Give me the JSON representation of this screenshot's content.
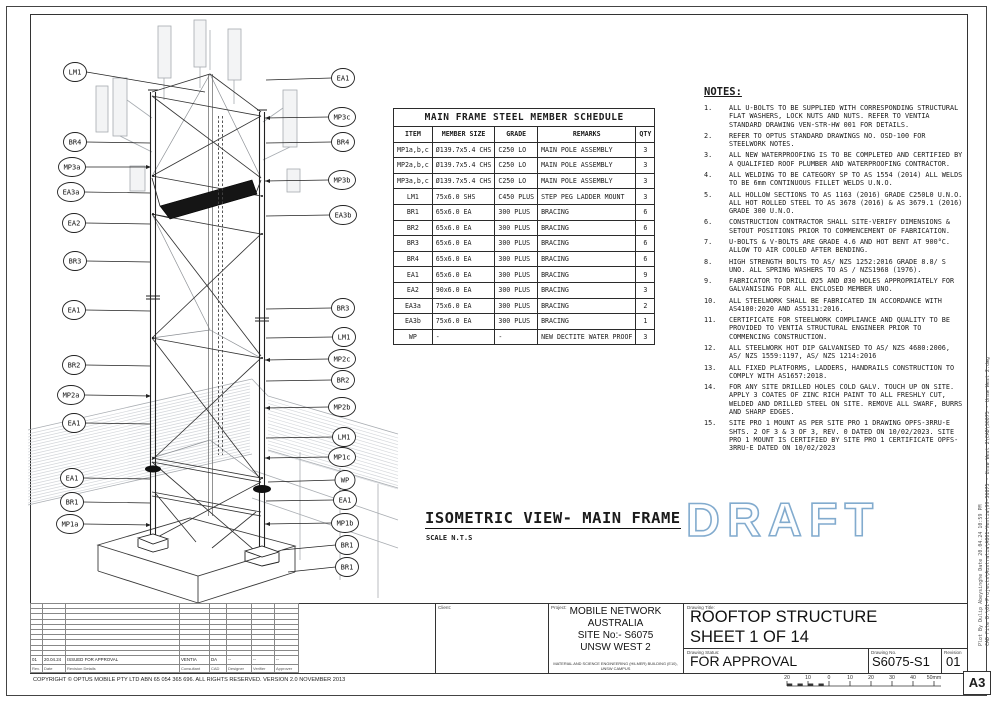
{
  "sheet": {
    "paper_size": "A3",
    "copyright": "COPYRIGHT © OPTUS MOBILE PTY LTD  ABN 65 054 365 696. ALL RIGHTS RESERVED. VERSION 2.0 NOVEMBER 2013",
    "cad_file_note": "CAD File  D:\\01-Projects\\Australia\\A001-Ventia\\99-S6075 - Unsw West 2\\CAD\\S6075 - Unsw West 2.dwg",
    "plot_note": "Plot By  Dulip Abeysinghe   Date  20.04.24 10:59 PM"
  },
  "view": {
    "title": "ISOMETRIC VIEW- MAIN FRAME",
    "scale": "SCALE N.T.S",
    "watermark": "DRAFT",
    "watermark_color": "#82abce"
  },
  "schedule": {
    "title": "MAIN FRAME STEEL MEMBER SCHEDULE",
    "headers": [
      "ITEM",
      "MEMBER SIZE",
      "GRADE",
      "REMARKS",
      "QTY"
    ],
    "rows": [
      {
        "item": "MP1a,b,c",
        "size": "Ø139.7x5.4 CHS",
        "grade": "C250 LO",
        "remarks": "MAIN POLE ASSEMBLY",
        "qty": "3"
      },
      {
        "item": "MP2a,b,c",
        "size": "Ø139.7x5.4 CHS",
        "grade": "C250 LO",
        "remarks": "MAIN POLE ASSEMBLY",
        "qty": "3"
      },
      {
        "item": "MP3a,b,c",
        "size": "Ø139.7x5.4 CHS",
        "grade": "C250 LO",
        "remarks": "MAIN POLE ASSEMBLY",
        "qty": "3"
      },
      {
        "item": "LM1",
        "size": "75x6.0 SHS",
        "grade": "C450 PLUS",
        "remarks": "STEP PEG LADDER MOUNT",
        "qty": "3"
      },
      {
        "item": "BR1",
        "size": "65x6.0 EA",
        "grade": "300 PLUS",
        "remarks": "BRACING",
        "qty": "6"
      },
      {
        "item": "BR2",
        "size": "65x6.0 EA",
        "grade": "300 PLUS",
        "remarks": "BRACING",
        "qty": "6"
      },
      {
        "item": "BR3",
        "size": "65x6.0 EA",
        "grade": "300 PLUS",
        "remarks": "BRACING",
        "qty": "6"
      },
      {
        "item": "BR4",
        "size": "65x6.0 EA",
        "grade": "300 PLUS",
        "remarks": "BRACING",
        "qty": "6"
      },
      {
        "item": "EA1",
        "size": "65x6.0 EA",
        "grade": "300 PLUS",
        "remarks": "BRACING",
        "qty": "9"
      },
      {
        "item": "EA2",
        "size": "90x6.0 EA",
        "grade": "300 PLUS",
        "remarks": "BRACING",
        "qty": "3"
      },
      {
        "item": "EA3a",
        "size": "75x6.0 EA",
        "grade": "300 PLUS",
        "remarks": "BRACING",
        "qty": "2"
      },
      {
        "item": "EA3b",
        "size": "75x6.0 EA",
        "grade": "300 PLUS",
        "remarks": "BRACING",
        "qty": "1"
      },
      {
        "item": "WP",
        "size": "-",
        "grade": "-",
        "remarks": "NEW DECTITE WATER PROOF",
        "qty": "3"
      }
    ]
  },
  "notes": {
    "title": "NOTES:",
    "items": [
      "ALL U-BOLTS TO BE SUPPLIED WITH CORRESPONDING STRUCTURAL FLAT WASHERS, LOCK NUTS AND NUTS. REFER TO VENTIA STANDARD DRAWING VEN-STR-HW 001 FOR DETAILS.",
      "REFER TO OPTUS STANDARD DRAWINGS NO. OSD-100 FOR STEELWORK NOTES.",
      "ALL NEW WATERPROOFING IS TO BE COMPLETED AND CERTIFIED BY A QUALIFIED ROOF PLUMBER AND WATERPROOFING CONTRACTOR.",
      "ALL WELDING TO BE CATEGORY SP TO AS 1554 (2014) ALL WELDS TO BE 6mm CONTINUOUS FILLET WELDS U.N.O.",
      "ALL HOLLOW SECTIONS TO AS 1163 (2016) GRADE C250L0 U.N.O. ALL HOT ROLLED STEEL TO AS 3678 (2016) & AS 3679.1 (2016) GRADE 300 U.N.O.",
      "CONSTRUCTION CONTRACTOR SHALL SITE-VERIFY DIMENSIONS & SETOUT POSITIONS PRIOR TO COMMENCEMENT OF FABRICATION.",
      "U-BOLTS & V-BOLTS ARE GRADE 4.6 AND HOT BENT AT 900°C. ALLOW TO AIR COOLED AFTER BENDING.",
      "HIGH STRENGTH BOLTS TO AS/ NZS 1252:2016 GRADE 8.8/ S UNO. ALL SPRING WASHERS TO AS / NZS1968 (1976).",
      "FABRICATOR TO DRILL Ø25 AND Ø30 HOLES APPROPRIATELY FOR GALVANISING FOR ALL ENCLOSED MEMBER UNO.",
      "ALL STEELWORK SHALL BE FABRICATED IN ACCORDANCE WITH AS4100:2020 AND AS5131:2016.",
      "CERTIFICATE FOR STEELWORK COMPLIANCE AND QUALITY TO BE PROVIDED TO VENTIA STRUCTURAL ENGINEER PRIOR TO COMMENCING CONSTRUCTION.",
      "ALL STEELWORK HOT DIP GALVANISED TO AS/ NZS 4680:2006, AS/ NZS 1559:1197, AS/ NZS 1214:2016",
      "ALL FIXED PLATFORMS, LADDERS, HANDRAILS CONSTRUCTION TO COMPLY WITH AS1657:2018.",
      "FOR ANY SITE DRILLED HOLES COLD GALV. TOUCH UP ON SITE. APPLY 3 COATES OF ZINC RICH PAINT TO ALL FRESHLY CUT, WELDED AND DRILLED STEEL ON SITE. REMOVE ALL SWARF, BURRS AND SHARP EDGES.",
      "SITE PRO 1 MOUNT AS PER SITE PRO 1 DRAWING OPFS-3RRU-E SHTS. 2 OF 3 & 3 OF 3, REV. 0 DATED ON 10/02/2023. SITE PRO 1 MOUNT IS CERTIFIED BY SITE PRO 1 CERTIFICATE OPFS-3RRU-E DATED ON 10/02/2023"
    ]
  },
  "callouts": {
    "left": [
      {
        "label": "LM1",
        "cx": 75,
        "cy": 72,
        "tx": 205,
        "ty": 92
      },
      {
        "label": "BR4",
        "cx": 75,
        "cy": 142,
        "tx": 150,
        "ty": 143
      },
      {
        "label": "MP3a",
        "cx": 72,
        "cy": 167,
        "tx": 151,
        "ty": 167
      },
      {
        "label": "EA3a",
        "cx": 71,
        "cy": 192,
        "tx": 150,
        "ty": 193
      },
      {
        "label": "EA2",
        "cx": 74,
        "cy": 223,
        "tx": 150,
        "ty": 224
      },
      {
        "label": "BR3",
        "cx": 75,
        "cy": 261,
        "tx": 150,
        "ty": 262
      },
      {
        "label": "EA1",
        "cx": 74,
        "cy": 310,
        "tx": 150,
        "ty": 311
      },
      {
        "label": "BR2",
        "cx": 74,
        "cy": 365,
        "tx": 150,
        "ty": 366
      },
      {
        "label": "MP2a",
        "cx": 71,
        "cy": 395,
        "tx": 151,
        "ty": 396
      },
      {
        "label": "EA1",
        "cx": 74,
        "cy": 423,
        "tx": 150,
        "ty": 424
      },
      {
        "label": "EA1",
        "cx": 72,
        "cy": 478,
        "tx": 150,
        "ty": 479
      },
      {
        "label": "BR1",
        "cx": 72,
        "cy": 502,
        "tx": 150,
        "ty": 503
      },
      {
        "label": "MP1a",
        "cx": 70,
        "cy": 524,
        "tx": 151,
        "ty": 525
      }
    ],
    "right": [
      {
        "label": "EA1",
        "cx": 343,
        "cy": 78,
        "tx": 266,
        "ty": 80
      },
      {
        "label": "MP3c",
        "cx": 342,
        "cy": 117,
        "tx": 265,
        "ty": 118
      },
      {
        "label": "BR4",
        "cx": 343,
        "cy": 142,
        "tx": 266,
        "ty": 143
      },
      {
        "label": "MP3b",
        "cx": 342,
        "cy": 180,
        "tx": 265,
        "ty": 181
      },
      {
        "label": "EA3b",
        "cx": 343,
        "cy": 215,
        "tx": 266,
        "ty": 216
      },
      {
        "label": "BR3",
        "cx": 343,
        "cy": 308,
        "tx": 266,
        "ty": 309
      },
      {
        "label": "LM1",
        "cx": 344,
        "cy": 337,
        "tx": 266,
        "ty": 338
      },
      {
        "label": "MP2c",
        "cx": 342,
        "cy": 359,
        "tx": 265,
        "ty": 360
      },
      {
        "label": "BR2",
        "cx": 343,
        "cy": 380,
        "tx": 266,
        "ty": 381
      },
      {
        "label": "MP2b",
        "cx": 342,
        "cy": 407,
        "tx": 265,
        "ty": 408
      },
      {
        "label": "LM1",
        "cx": 344,
        "cy": 437,
        "tx": 266,
        "ty": 438
      },
      {
        "label": "MP1c",
        "cx": 342,
        "cy": 457,
        "tx": 265,
        "ty": 458
      },
      {
        "label": "WP",
        "cx": 345,
        "cy": 480,
        "tx": 268,
        "ty": 482
      },
      {
        "label": "EA1",
        "cx": 345,
        "cy": 500,
        "tx": 266,
        "ty": 501
      },
      {
        "label": "MP1b",
        "cx": 345,
        "cy": 523,
        "tx": 265,
        "ty": 524
      },
      {
        "label": "BR1",
        "cx": 347,
        "cy": 545,
        "tx": 282,
        "ty": 550
      },
      {
        "label": "BR1",
        "cx": 347,
        "cy": 567,
        "tx": 288,
        "ty": 572
      }
    ]
  },
  "title_block": {
    "client_label": "Client:",
    "project_label": "Project:",
    "project_lines": [
      "MOBILE NETWORK",
      "AUSTRALIA",
      "SITE No:- S6075",
      "UNSW WEST 2"
    ],
    "project_sub": "MATERIAL AND SCIENCE ENGINEERING (HILMER) BUILDING (E10), UNSW CAMPUS",
    "drawing_title_label": "Drawing Title:",
    "drawing_title_lines": [
      "ROOFTOP STRUCTURE",
      "SHEET 1 OF 14"
    ],
    "status_label": "Drawing Status:",
    "status": "FOR APPROVAL",
    "number_label": "Drawing No.",
    "number": "S6075-S1",
    "revision_label": "Revision",
    "revision": "01",
    "revision_table": {
      "headers": [
        "Rev.",
        "Date",
        "Revision Details",
        "Consultant",
        "CAD",
        "Designer",
        "Verifier",
        "Approver"
      ],
      "row": {
        "rev": "01",
        "date": "20.04.24",
        "details": "ISSUED FOR APPROVAL",
        "consultant": "VENTIA",
        "cad": "DA",
        "designer": "--",
        "verifier": "--",
        "approver": "--"
      }
    },
    "scale_bar_labels": [
      "20",
      "10",
      "0",
      "10",
      "20",
      "30",
      "40",
      "50mm"
    ]
  }
}
